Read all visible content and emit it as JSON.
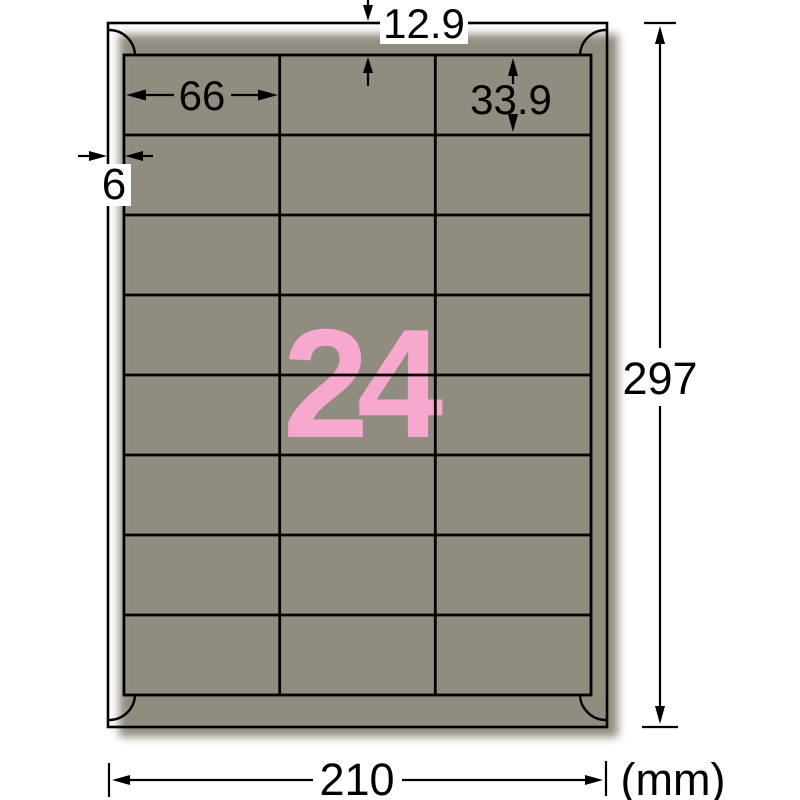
{
  "sheet": {
    "label_count": "24",
    "accent_color": "#f6a8ce",
    "columns": 3,
    "rows": 8
  },
  "dimensions": {
    "top_margin": "12.9",
    "label_width": "66",
    "label_height": "33.9",
    "side_margin": "6",
    "page_height": "297",
    "page_width": "210",
    "unit": "(mm)"
  }
}
